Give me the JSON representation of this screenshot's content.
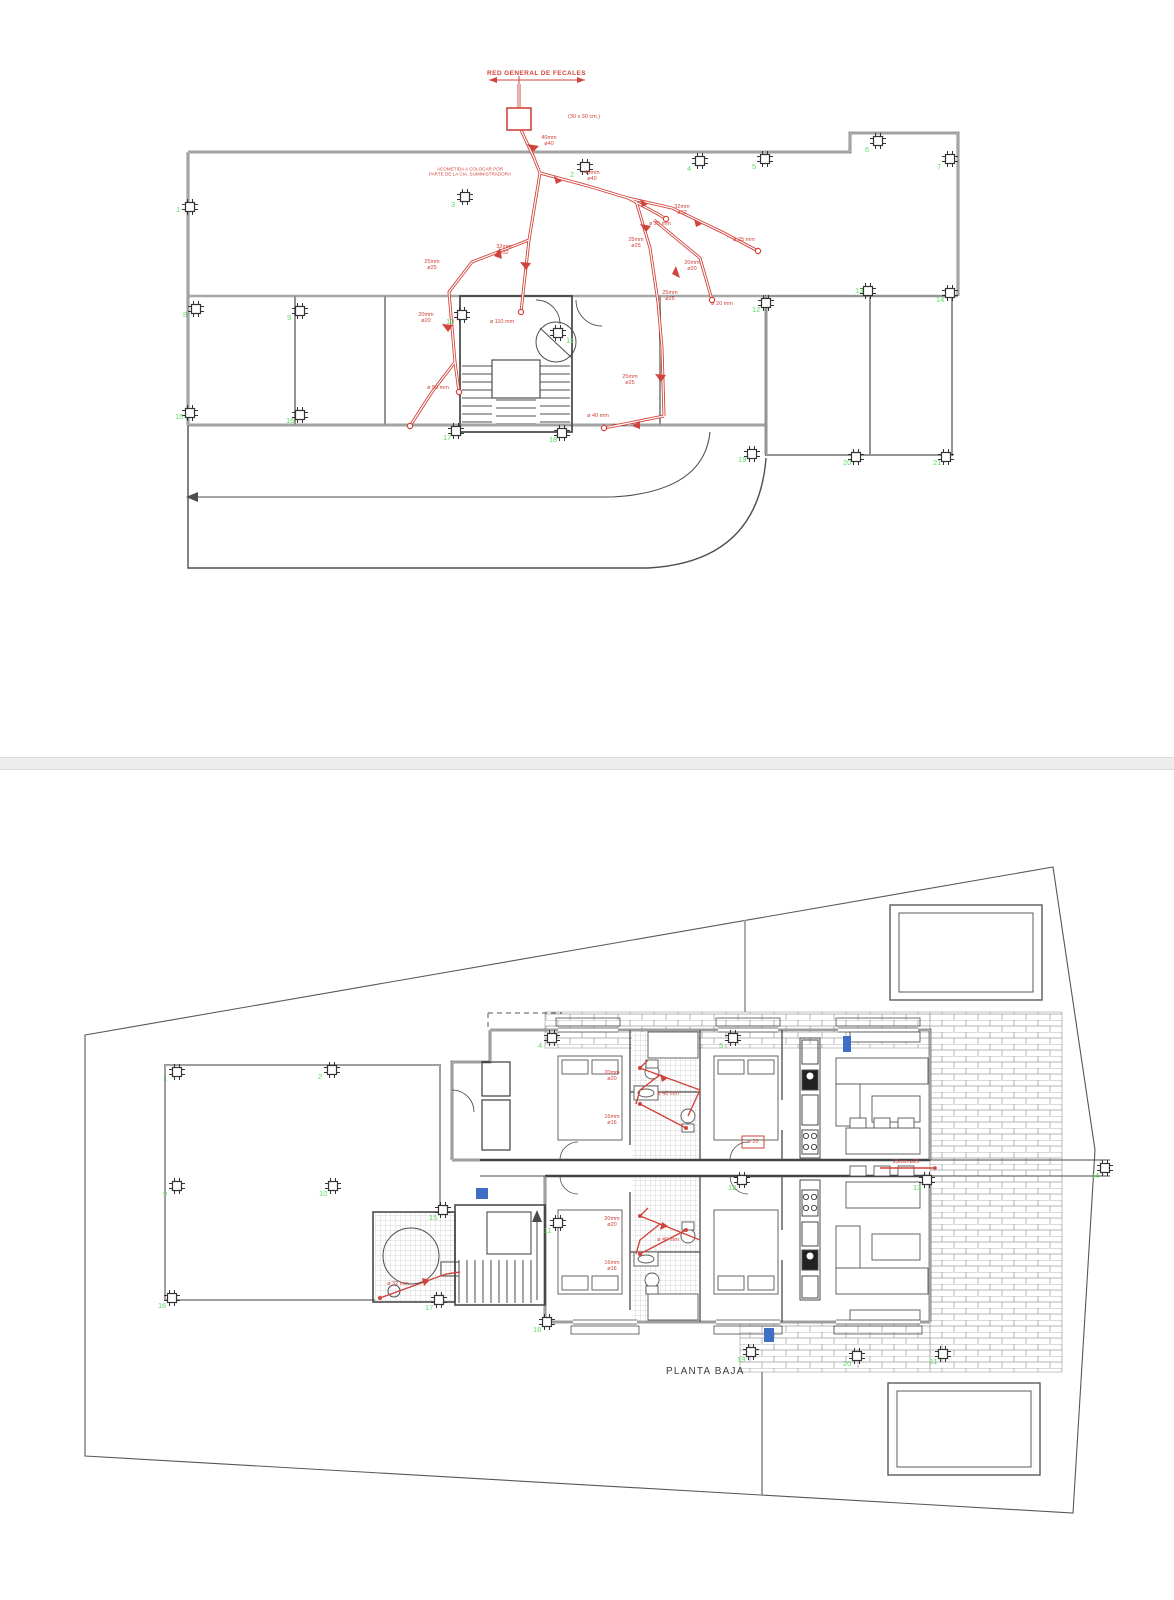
{
  "colors": {
    "pipe_red": "#d0443c",
    "marker_green": "#5fdb64",
    "accent_blue": "#3f6fc4",
    "line_gray": "#4a4a4a"
  },
  "roof": {
    "title": "RED GENERAL DE FECALES",
    "meter_box_label": "(30 x 30 cm.)",
    "service_note": "ACOMETIDA A COLOCAR POR\nPARTE DE LA CIA. SUMINISTRADORA",
    "columns": [
      "1",
      "2",
      "3",
      "4",
      "5",
      "6",
      "7",
      "8",
      "9",
      "10",
      "11",
      "12",
      "13",
      "14",
      "15",
      "16",
      "17",
      "18",
      "19",
      "20",
      "21"
    ],
    "pipe_labels": [
      "40mm\nø40",
      "32mm\nø32",
      "25mm\nø25",
      "20mm\nø20",
      "ø 110 mm",
      "40mm\nø40",
      "25mm\nø25",
      "32mm\nø32",
      "ø 25 mm",
      "25mm\nø25",
      "20mm\nø20",
      "ø 20 mm",
      "25mm\nø25",
      "ø 40 mm",
      "ø 50 mm",
      "ø 25 mm"
    ]
  },
  "floor": {
    "title": "PLANTA BAJA",
    "columns": [
      "1",
      "2",
      "4",
      "5",
      "9",
      "10",
      "11",
      "12",
      "13",
      "14",
      "15",
      "16",
      "17",
      "18",
      "19",
      "20",
      "21"
    ],
    "pipe_labels": [
      "20mm\nø20",
      "ø 40 mm",
      "16mm\nø16",
      "20mm\nø20",
      "ø 40 mm",
      "16mm\nø16",
      "ø 32 mm",
      "25mm ø25",
      "ø 20"
    ]
  }
}
